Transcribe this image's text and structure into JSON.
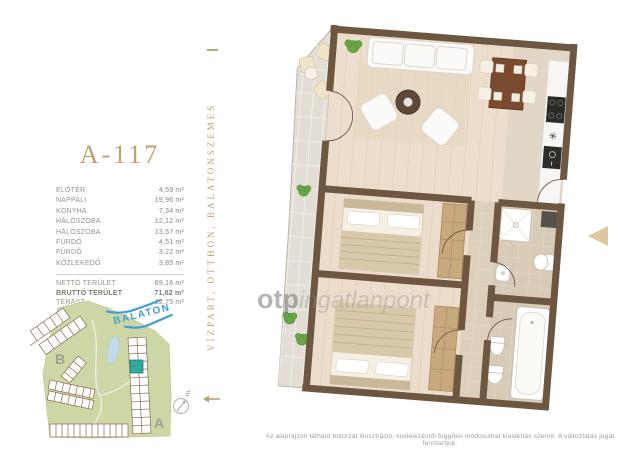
{
  "title": "A-117",
  "banner": {
    "text": "VÍZPART, OTTHON, BALATONSZEMES"
  },
  "rooms": [
    {
      "label": "ELŐTÉR",
      "value": "4,59 m²"
    },
    {
      "label": "NAPPALI",
      "value": "19,96 m²"
    },
    {
      "label": "KONYHA",
      "value": "7,34 m²"
    },
    {
      "label": "HÁLÓSZOBA",
      "value": "12,12 m²"
    },
    {
      "label": "HÁLÓSZOBA",
      "value": "13,57 m²"
    },
    {
      "label": "FÜRDŐ",
      "value": "4,51 m²"
    },
    {
      "label": "FÜRDŐ",
      "value": "3,22 m²"
    },
    {
      "label": "KÖZLEKEDŐ",
      "value": "3,85 m²"
    }
  ],
  "totals": [
    {
      "label": "NETTÓ TERÜLET",
      "value": "69,16 m²"
    },
    {
      "label": "BRUTTÓ TERÜLET",
      "value": "71,82 m²"
    },
    {
      "label": "TERASZ",
      "value": "12,75 m²"
    }
  ],
  "site_map": {
    "lake_label": "BALATON",
    "section_a": "A",
    "section_b": "B",
    "north_label": "É"
  },
  "watermark": {
    "bold": "otp",
    "light": "ingatlanpont"
  },
  "disclaimer": "Az alaprajzon látható bútorzat illusztráció, kivitelezéstől függően módosulhat kialakítás szerint. A változtatás jogát fenntartjuk.",
  "colors": {
    "accent_gold": "#bfa06a",
    "wall_brown": "#6e5740",
    "wood_floor": "#ecddcc",
    "tile": "#dbceba",
    "site_green": "#cdd7a5",
    "lake_blue": "#3f9ed8",
    "highlight_teal": "#33a69d",
    "text_gray": "#96938a"
  }
}
